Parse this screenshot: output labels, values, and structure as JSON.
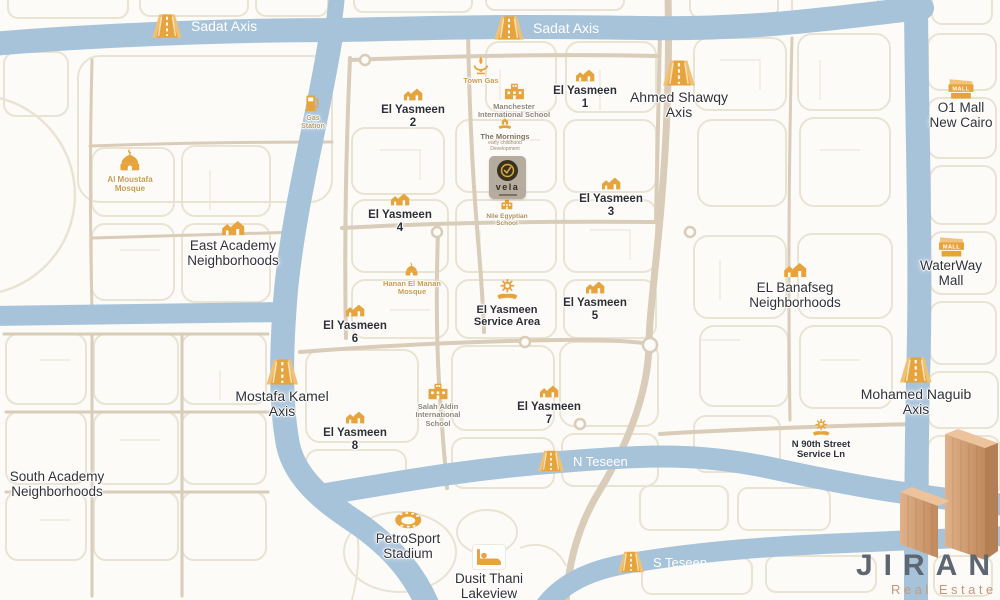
{
  "colors": {
    "road_blue": "#a7c3da",
    "road_beige": "#d9ccb8",
    "block_outline": "#eae3d4",
    "icon_gold": "#e7a33c",
    "label_dark": "#303238",
    "label_gold": "#c99c4f",
    "label_muted": "#8f8678",
    "road_text_white": "#ffffff",
    "jiran_gray": "#5d6671",
    "jiran_copper": "#cb9a72",
    "vela_badge": "#b5ab9e",
    "vela_dark": "#37321f"
  },
  "roads": {
    "sadat_axis_west": "Sadat Axis",
    "sadat_axis_east": "Sadat Axis",
    "n_teseen": "N Teseen",
    "s_teseen": "S Teseen"
  },
  "axes": {
    "ahmed_shawqy": {
      "line1": "Ahmed Shawqy",
      "line2": "Axis"
    },
    "mostafa_kamel": {
      "line1": "Mostafa Kamel",
      "line2": "Axis"
    },
    "mohamed_naguib": {
      "line1": "Mohamed Naguib",
      "line2": "Axis"
    }
  },
  "districts": {
    "el_yasmeen_1": {
      "line1": "El Yasmeen",
      "line2": "1"
    },
    "el_yasmeen_2": {
      "line1": "El Yasmeen",
      "line2": "2"
    },
    "el_yasmeen_3": {
      "line1": "El Yasmeen",
      "line2": "3"
    },
    "el_yasmeen_4": {
      "line1": "El Yasmeen",
      "line2": "4"
    },
    "el_yasmeen_5": {
      "line1": "El Yasmeen",
      "line2": "5"
    },
    "el_yasmeen_6": {
      "line1": "El Yasmeen",
      "line2": "6"
    },
    "el_yasmeen_7": {
      "line1": "El Yasmeen",
      "line2": "7"
    },
    "el_yasmeen_8": {
      "line1": "El Yasmeen",
      "line2": "8"
    },
    "el_yasmeen_service": {
      "line1": "El Yasmeen",
      "line2": "Service Area"
    },
    "east_academy": {
      "line1": "East Academy",
      "line2": "Neighborhoods"
    },
    "south_academy": {
      "line1": "South Academy",
      "line2": "Neighborhoods"
    },
    "el_banafseg": {
      "line1": "EL Banafseg",
      "line2": "Neighborhoods"
    }
  },
  "places": {
    "o1_mall": {
      "line1": "O1 Mall",
      "line2": "New Cairo"
    },
    "waterway_mall": {
      "line1": "WaterWay",
      "line2": "Mall"
    },
    "al_moustafa_mosque": {
      "line1": "Al Moustafa",
      "line2": "Mosque"
    },
    "hanan_el_manan_mosque": {
      "line1": "Hanan El Manan",
      "line2": "Mosque"
    },
    "manchester_school": {
      "line1": "Manchester",
      "line2": "International School"
    },
    "salah_aldin_school": {
      "line1": "Salah Aldin",
      "line2": "International",
      "line3": "School"
    },
    "nile_egyptian_school": {
      "line1": "Nile Egyptian",
      "line2": "School"
    },
    "town_gas": {
      "line1": "Town Gas"
    },
    "gas_station": {
      "line1": "Gas",
      "line2": "Station"
    },
    "the_mornings": {
      "line1": "The Mornings",
      "line2": "early childhood",
      "line3": "Development"
    },
    "petrosport_stadium": {
      "line1": "PetroSport",
      "line2": "Stadium"
    },
    "dusit_thani": {
      "line1": "Dusit Thani",
      "line2": "Lakeview"
    },
    "n90_street_service": {
      "line1": "N 90th Street",
      "line2": "Service Ln"
    }
  },
  "brand": {
    "vela": "vela",
    "jiran": "JIRAN",
    "jiran_sub": "Real Estate",
    "mall_icon_text": "MALL"
  }
}
